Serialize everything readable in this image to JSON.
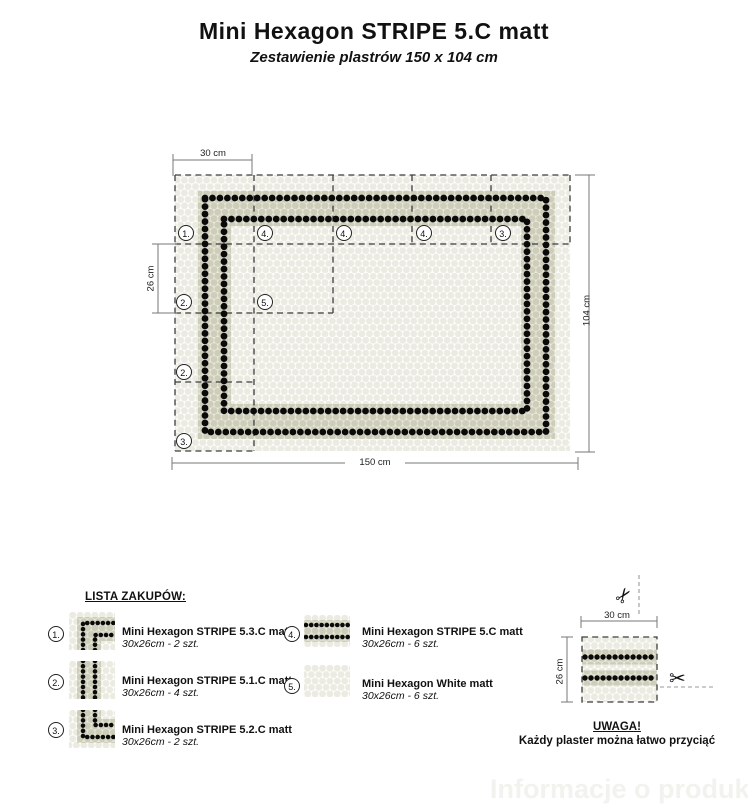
{
  "header": {
    "title": "Mini Hexagon STRIPE 5.C matt",
    "subtitle": "Zestawienie plastrów 150 x 104 cm"
  },
  "diagram": {
    "dim_top": "30 cm",
    "dim_left": "26 cm",
    "dim_right": "104 cm",
    "dim_bottom": "150 cm",
    "markers": [
      {
        "label": "1."
      },
      {
        "label": "4."
      },
      {
        "label": "4."
      },
      {
        "label": "4."
      },
      {
        "label": "3."
      },
      {
        "label": "2."
      },
      {
        "label": "5."
      },
      {
        "label": "2."
      },
      {
        "label": "3."
      }
    ]
  },
  "legend": {
    "heading": "LISTA ZAKUPÓW:",
    "items": [
      {
        "num": "1.",
        "name": "Mini Hexagon STRIPE 5.3.C matt",
        "qty": "30x26cm - 2 szt."
      },
      {
        "num": "2.",
        "name": "Mini Hexagon STRIPE 5.1.C matt",
        "qty": "30x26cm - 4 szt."
      },
      {
        "num": "3.",
        "name": "Mini Hexagon STRIPE 5.2.C matt",
        "qty": "30x26cm - 2 szt."
      },
      {
        "num": "4.",
        "name": "Mini Hexagon STRIPE 5.C matt",
        "qty": "30x26cm - 6 szt."
      },
      {
        "num": "5.",
        "name": "Mini Hexagon White matt",
        "qty": "30x26cm - 6 szt."
      }
    ]
  },
  "cut_note": {
    "dim_top": "30 cm",
    "dim_left": "26 cm",
    "warning_title": "UWAGA!",
    "warning_text": "Każdy plaster można łatwo przyciąć"
  },
  "icons": {
    "scissors": "✂"
  },
  "watermark": "Informacje o produkcie",
  "colors": {
    "tile_black": "#0a0a0a",
    "band_base": "#e8e8dc",
    "band_dot": "#cdcdba",
    "field_dot": "#ebebe2",
    "dash_line": "#3d3d3d"
  }
}
